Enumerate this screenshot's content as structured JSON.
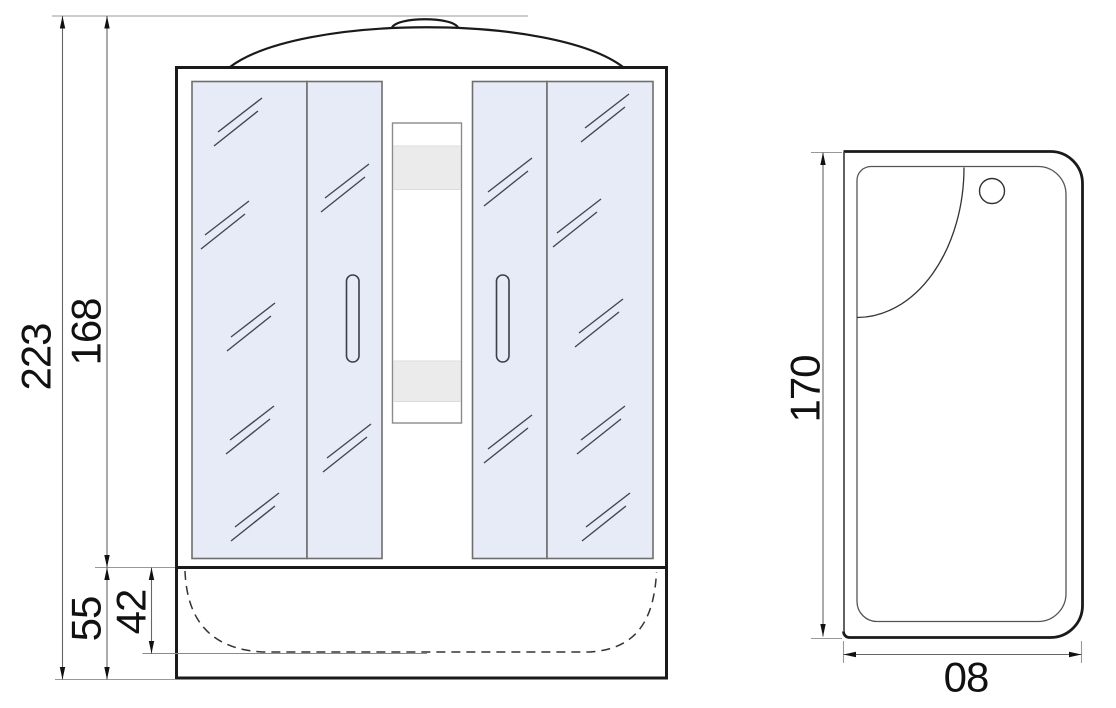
{
  "front_view": {
    "dimensions": {
      "total_height": "223",
      "door_section_height": "168",
      "tray_height": "55",
      "basin_inner_depth": "42"
    }
  },
  "top_view": {
    "dimensions": {
      "length": "170",
      "width": "08"
    }
  },
  "colors": {
    "glass_tint": "#e7ebf7",
    "band_gray": "#ebebeb"
  }
}
